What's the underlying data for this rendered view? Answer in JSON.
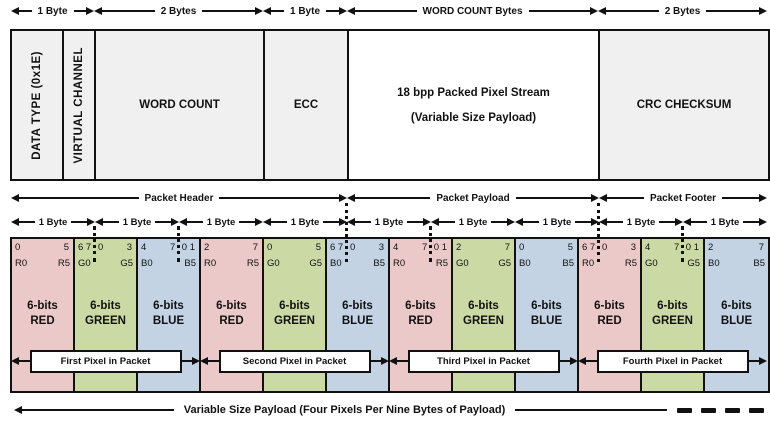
{
  "colors": {
    "red": "#ecc9c9",
    "green": "#cbd9a4",
    "blue": "#c3d3e4",
    "gray": "#f0f0f0",
    "white": "#ffffff",
    "ink": "#111111"
  },
  "top_arrows": [
    {
      "label": "1 Byte"
    },
    {
      "label": "2 Bytes"
    },
    {
      "label": "1 Byte"
    },
    {
      "label": "WORD COUNT Bytes"
    },
    {
      "label": "2 Bytes"
    }
  ],
  "packet_fields": {
    "data_type": "DATA TYPE (0x1E)",
    "virtual_channel": "VIRTUAL CHANNEL",
    "word_count": "WORD COUNT",
    "ecc": "ECC",
    "stream_line1": "18 bpp Packed Pixel Stream",
    "stream_line2": "(Variable Size Payload)",
    "crc": "CRC CHECKSUM"
  },
  "sections": [
    {
      "label": "Packet Header"
    },
    {
      "label": "Packet Payload"
    },
    {
      "label": "Packet Footer"
    }
  ],
  "byte_arrow_label": "1 Byte",
  "pixel_cells": [
    {
      "bits_left": "0",
      "bits_mid": "",
      "bits_right": "5",
      "chan_first": "R0",
      "chan_last": "R5",
      "name_line1": "6-bits",
      "name_line2": "RED"
    },
    {
      "bits_left": "6 7",
      "bits_mid": "0",
      "bits_right": "3",
      "chan_first": "G0",
      "chan_last": "G5",
      "name_line1": "6-bits",
      "name_line2": "GREEN"
    },
    {
      "bits_left": "4",
      "bits_mid": "7",
      "bits_right": "0 1",
      "chan_first": "B0",
      "chan_last": "B5",
      "name_line1": "6-bits",
      "name_line2": "BLUE"
    },
    {
      "bits_left": "2",
      "bits_mid": "",
      "bits_right": "7",
      "chan_first": "R0",
      "chan_last": "R5",
      "name_line1": "6-bits",
      "name_line2": "RED"
    },
    {
      "bits_left": "0",
      "bits_mid": "",
      "bits_right": "5",
      "chan_first": "G0",
      "chan_last": "G5",
      "name_line1": "6-bits",
      "name_line2": "GREEN"
    },
    {
      "bits_left": "6 7",
      "bits_mid": "0",
      "bits_right": "3",
      "chan_first": "B0",
      "chan_last": "B5",
      "name_line1": "6-bits",
      "name_line2": "BLUE"
    },
    {
      "bits_left": "4",
      "bits_mid": "7",
      "bits_right": "0 1",
      "chan_first": "R0",
      "chan_last": "R5",
      "name_line1": "6-bits",
      "name_line2": "RED"
    },
    {
      "bits_left": "2",
      "bits_mid": "",
      "bits_right": "7",
      "chan_first": "G0",
      "chan_last": "G5",
      "name_line1": "6-bits",
      "name_line2": "GREEN"
    },
    {
      "bits_left": "0",
      "bits_mid": "",
      "bits_right": "5",
      "chan_first": "B0",
      "chan_last": "B5",
      "name_line1": "6-bits",
      "name_line2": "BLUE"
    },
    {
      "bits_left": "6 7",
      "bits_mid": "0",
      "bits_right": "3",
      "chan_first": "R0",
      "chan_last": "R5",
      "name_line1": "6-bits",
      "name_line2": "RED"
    },
    {
      "bits_left": "4",
      "bits_mid": "7",
      "bits_right": "0 1",
      "chan_first": "G0",
      "chan_last": "G5",
      "name_line1": "6-bits",
      "name_line2": "GREEN"
    },
    {
      "bits_left": "2",
      "bits_mid": "",
      "bits_right": "7",
      "chan_first": "B0",
      "chan_last": "B5",
      "name_line1": "6-bits",
      "name_line2": "BLUE"
    }
  ],
  "pixel_boxes": [
    {
      "label": "First Pixel in Packet"
    },
    {
      "label": "Second Pixel in Packet"
    },
    {
      "label": "Third Pixel in Packet"
    },
    {
      "label": "Fourth Pixel in Packet"
    }
  ],
  "footer_label": "Variable Size Payload  (Four Pixels Per Nine Bytes of Payload)"
}
